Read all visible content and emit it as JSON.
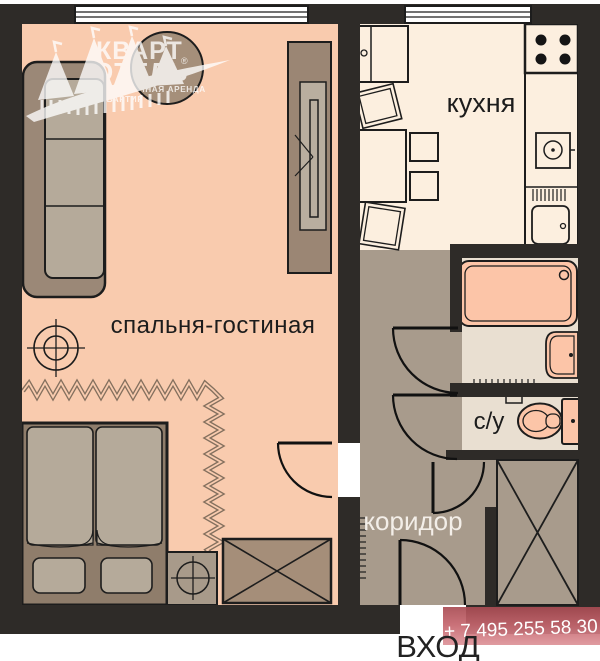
{
  "logo": {
    "brand_line1": "КВАРТ",
    "brand_line2": "ОТЕЛЬ",
    "registered_mark": "®",
    "tagline_line1": "ПОСУТОЧНАЯ АРЕНДА",
    "tagline_line2": "КВАРТИР"
  },
  "rooms": {
    "bedroom_living": {
      "label": "спальня-гостиная"
    },
    "kitchen": {
      "label": "кухня"
    },
    "wc": {
      "label": "с/у"
    },
    "corridor": {
      "label": "коридор"
    }
  },
  "entrance_label": "ВХОД",
  "phone": "+ 7 495 255 58 30",
  "colors": {
    "wall": "#2e2b28",
    "bedroom_floor": "#f9cbae",
    "kitchen_floor": "#fcefdf",
    "corridor_floor": "#a89b8c",
    "bathroom_floor": "#e9dfd1",
    "fixture_pink": "#fcc5a8",
    "furniture_dark": "#93806e",
    "furniture_light": "#b5aa9a",
    "line_dark": "#1d1d1d",
    "banner_red_dark": "#a84b52",
    "banner_red": "#c4646c",
    "banner_red_light": "#dd9298"
  },
  "fixtures": [
    "sofa",
    "round-table",
    "tv-stand",
    "ceiling-light",
    "curtain-divider",
    "double-bed",
    "bedside-table",
    "wardrobe",
    "fridge",
    "dining-table",
    "chair",
    "stove",
    "washing-machine",
    "kitchen-sink",
    "bathtub",
    "washbasin",
    "toilet",
    "towel-radiator",
    "hall-radiator",
    "built-in-closet",
    "window",
    "door"
  ]
}
